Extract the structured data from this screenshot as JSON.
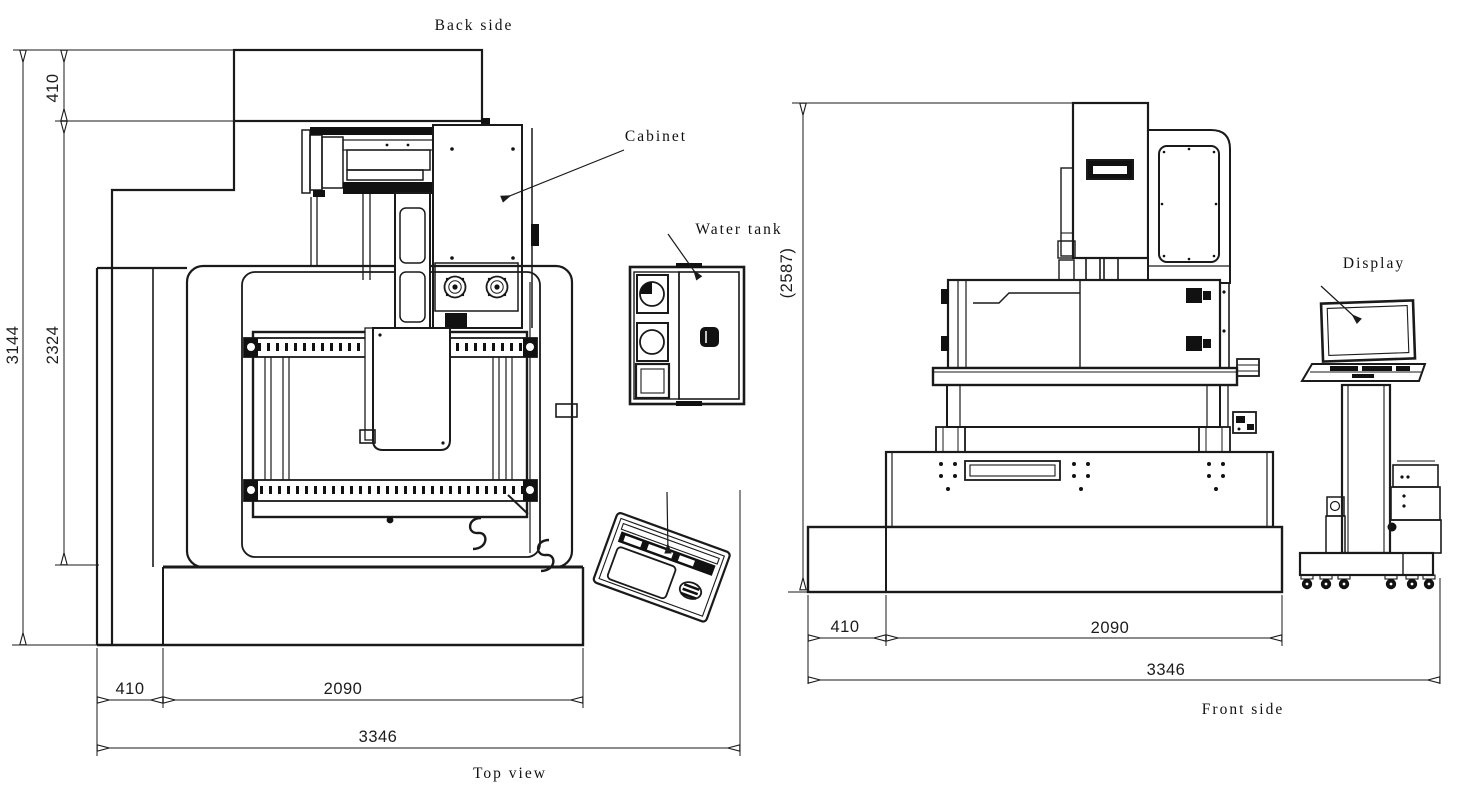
{
  "drawing": {
    "background": "#ffffff",
    "line_color": "#1a1a1a",
    "top_view": {
      "caption": "Top view",
      "back_label": "Back side",
      "cabinet_label": "Cabinet",
      "water_tank_label": "Water tank",
      "dim_overall_height": "3144",
      "dim_body_height": "2324",
      "dim_back_depth": "410",
      "dim_left_section": "410",
      "dim_base_width": "2090",
      "dim_overall_width": "3346"
    },
    "front_view": {
      "caption": "Front side",
      "display_label": "Display",
      "dim_overall_height": "(2587)",
      "dim_left_section": "410",
      "dim_base_width": "2090",
      "dim_overall_width": "3346"
    }
  }
}
